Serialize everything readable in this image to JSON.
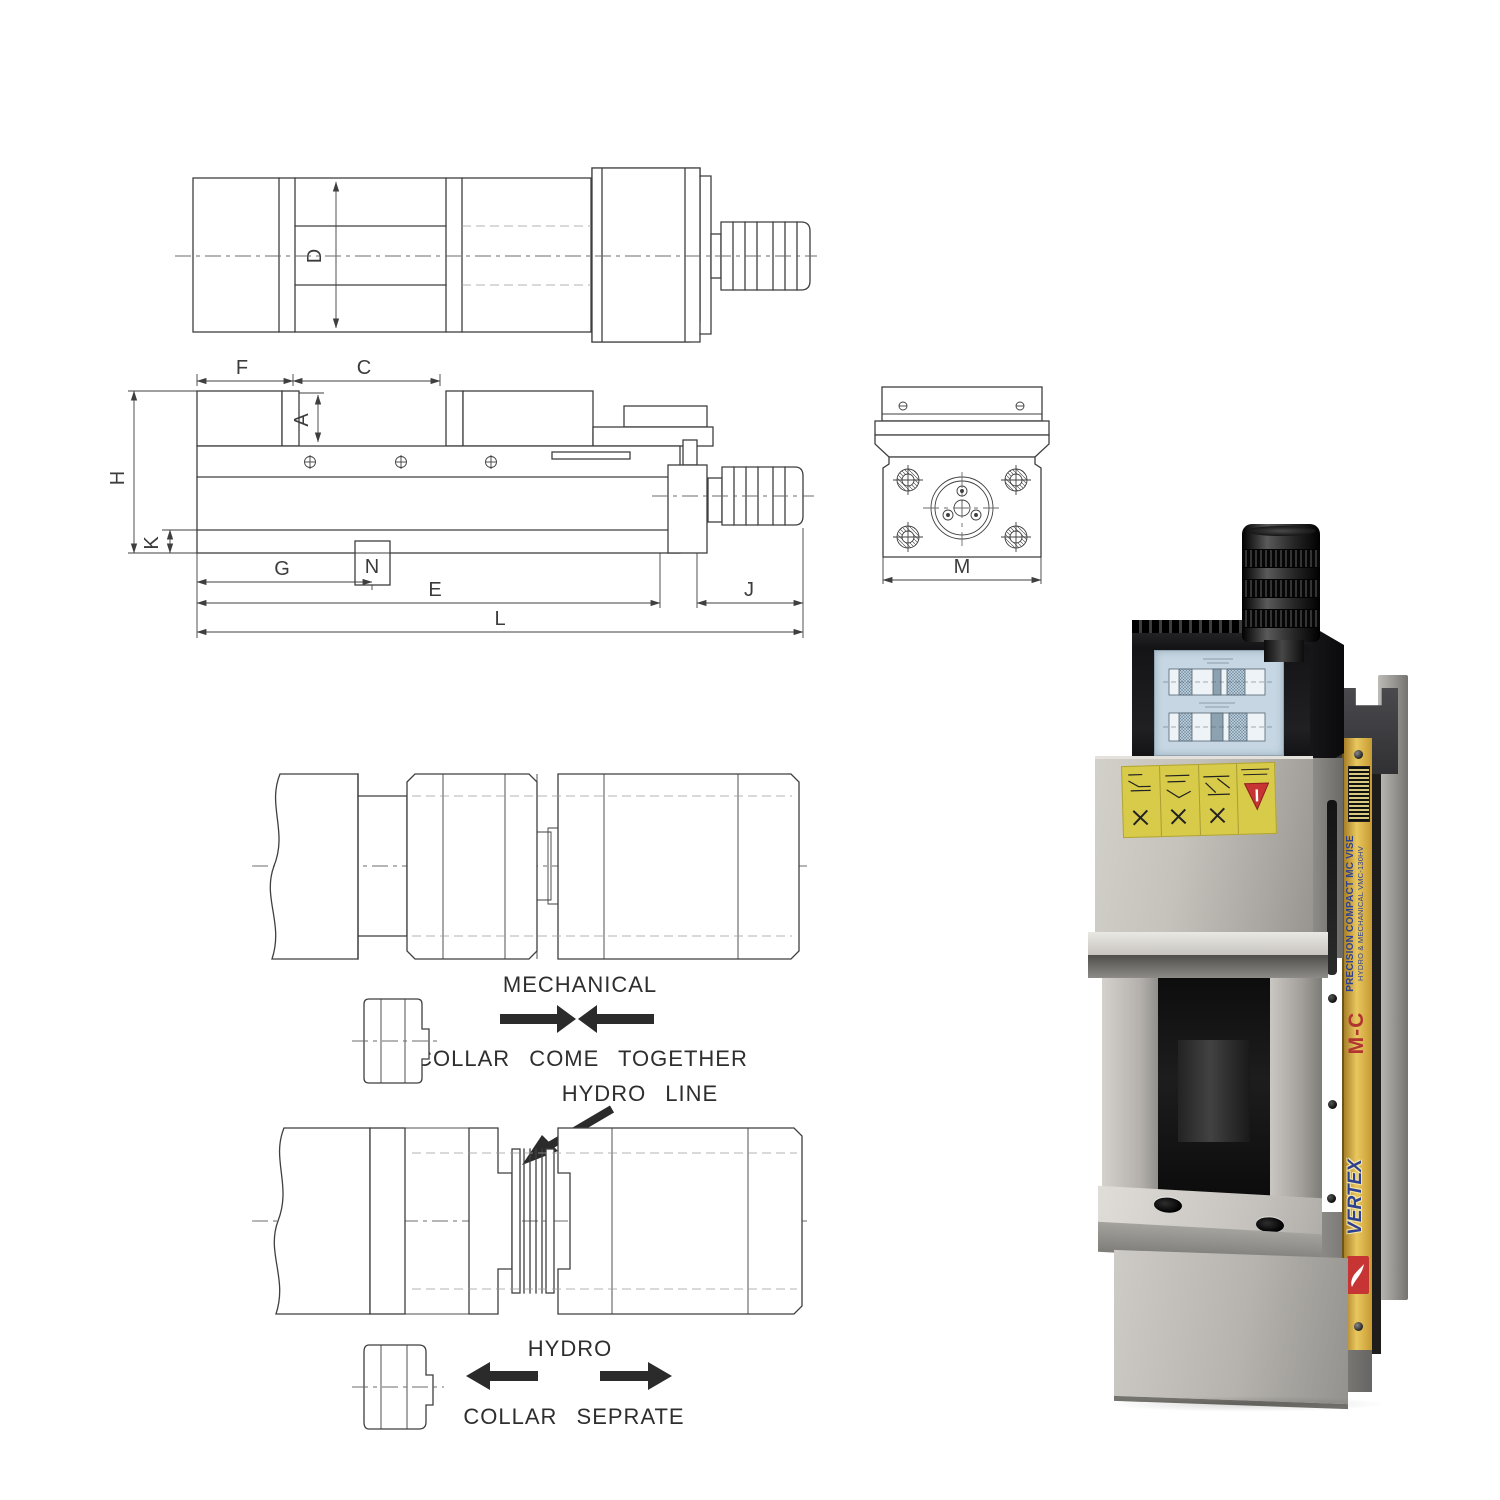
{
  "page": {
    "background_color": "#ffffff"
  },
  "drawings": {
    "top_view": {
      "dim_d": "D"
    },
    "side_view": {
      "dim_f": "F",
      "dim_c": "C",
      "dim_a": "A",
      "dim_h": "H",
      "dim_k": "K",
      "dim_g": "G",
      "dim_n": "N",
      "dim_e": "E",
      "dim_j": "J",
      "dim_l": "L"
    },
    "end_view": {
      "dim_m": "M"
    },
    "mechanical_detail": {
      "title": "MECHANICAL",
      "caption": "COLLAR COME TOGETHER"
    },
    "hydro_detail": {
      "callout": "HYDRO LINE",
      "title": "HYDRO",
      "caption": "COLLAR SEPRATE"
    }
  },
  "product_photo": {
    "side_strip": {
      "brand": "VERTEX",
      "series_code": "M-C",
      "title": "PRECISION COMPACT MC VISE",
      "subtitle": "HYDRO & MECHANICAL VMC-130HV"
    }
  },
  "colors": {
    "drawing_line": "#3f3f3f",
    "hatch_fill": "#b8dbe8",
    "hatch_stroke": "#6f8d9c",
    "strip_yellow": "#e9c75f",
    "strip_text_blue": "#2e4191",
    "strip_text_red": "#b23432",
    "warning_label_yellow": "#d8cb49",
    "warning_red": "#c63434",
    "instruction_label_blue": "#c6d7e3",
    "metal_light": "#d3d0ca",
    "metal_dark": "#757371",
    "black_part": "#141416"
  }
}
